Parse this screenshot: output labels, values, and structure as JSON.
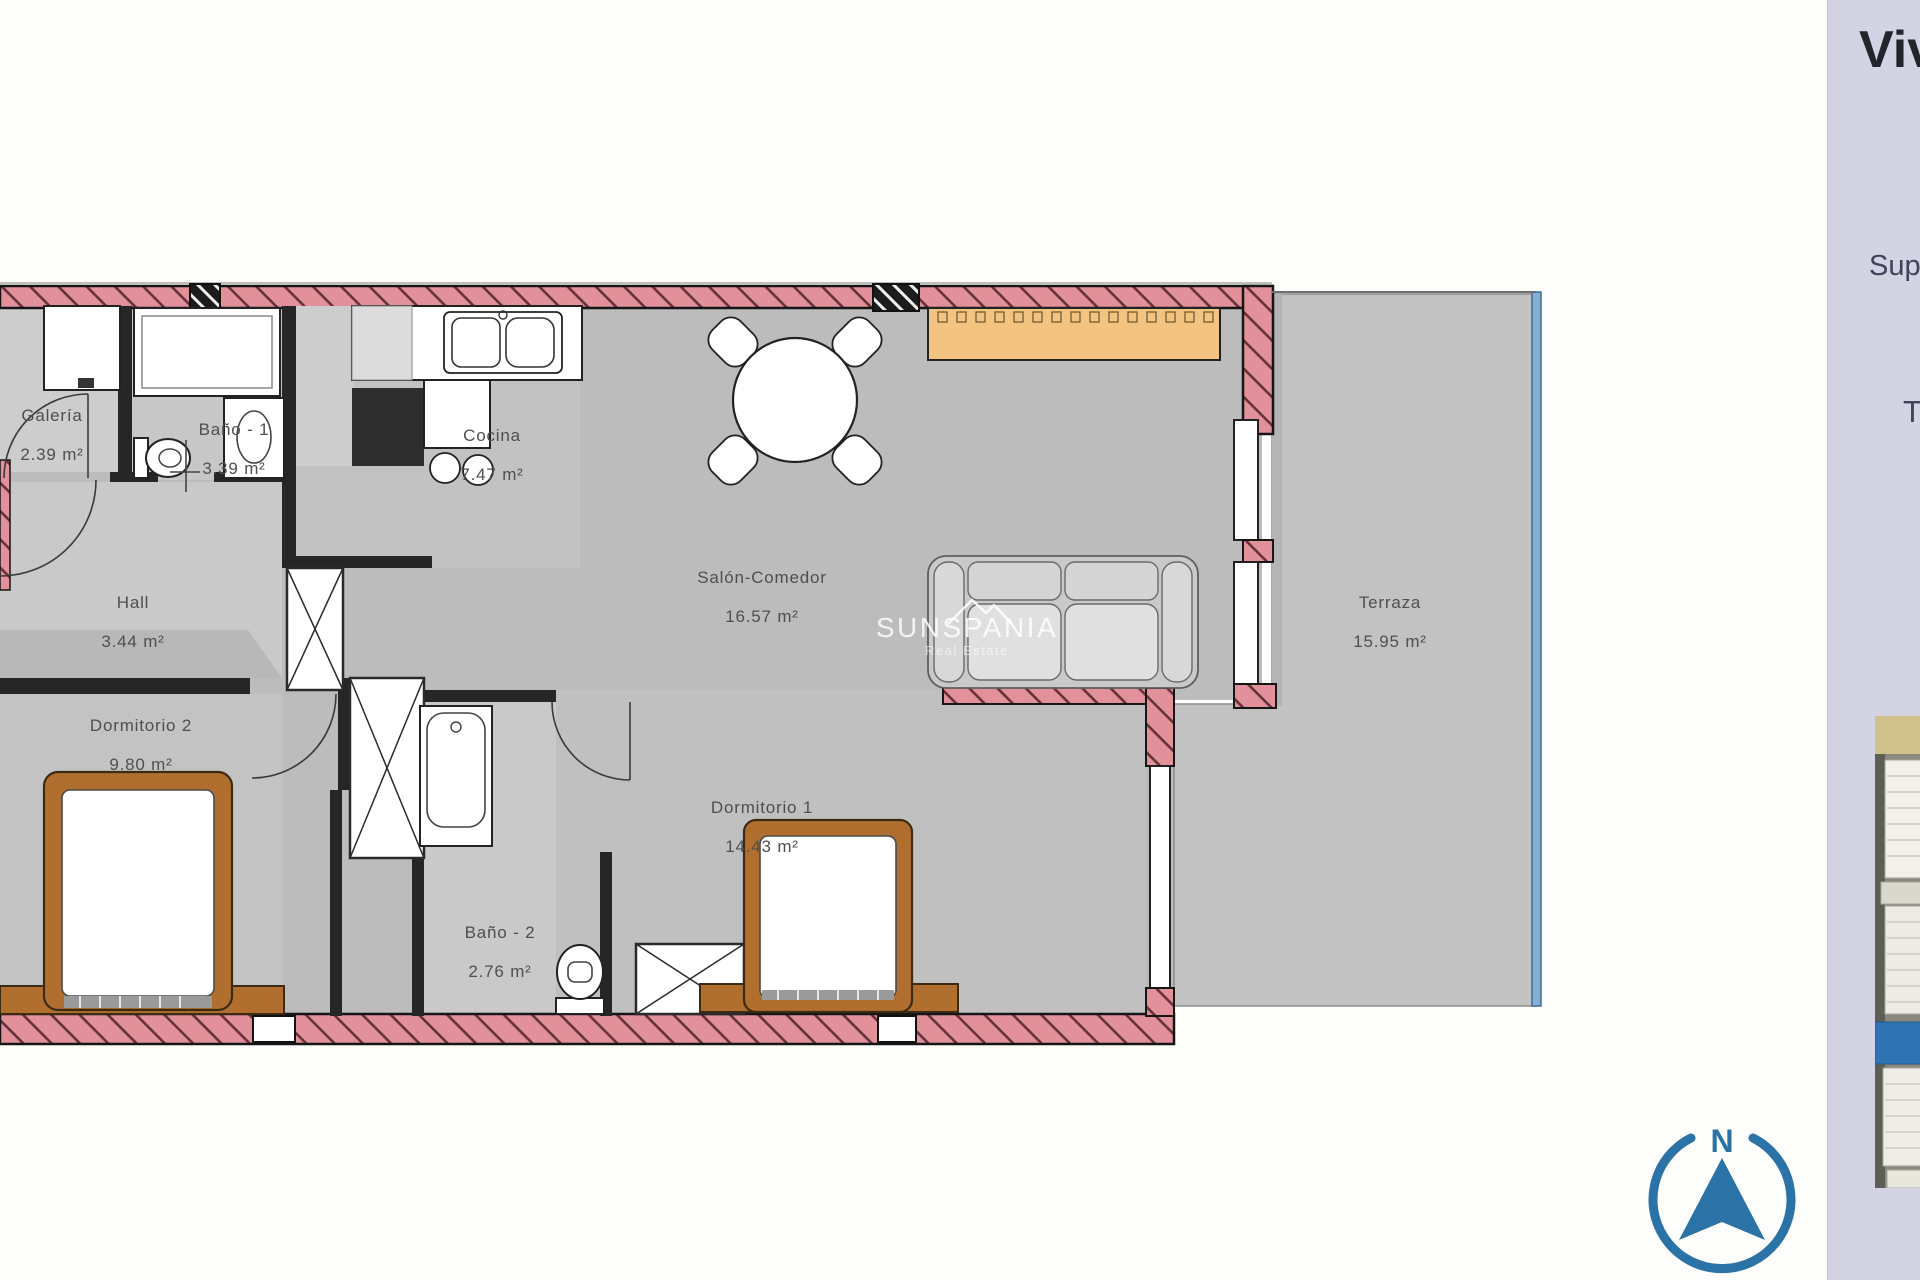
{
  "rooms": {
    "galeria": {
      "name": "Galería",
      "area": "2.39 m²"
    },
    "bano1": {
      "name": "Baño - 1",
      "area": "3.39 m²"
    },
    "cocina": {
      "name": "Cocina",
      "area": "7.47 m²"
    },
    "salon": {
      "name": "Salón-Comedor",
      "area": "16.57 m²"
    },
    "hall": {
      "name": "Hall",
      "area": "3.44 m²"
    },
    "dorm2": {
      "name": "Dormitorio 2",
      "area": "9.80 m²"
    },
    "dorm1": {
      "name": "Dormitorio 1",
      "area": "14.43 m²"
    },
    "bano2": {
      "name": "Baño - 2",
      "area": "2.76 m²"
    },
    "terraza": {
      "name": "Terraza",
      "area": "15.95 m²"
    }
  },
  "watermark": {
    "brand": "SUNSPANIA",
    "tagline": "Real Estate"
  },
  "panel": {
    "title_partial": "Viv",
    "subtitle_partial": "Sup",
    "line_partial": "T"
  },
  "compass": {
    "north_label": "N"
  },
  "colors": {
    "wall_pink": "#e2919b",
    "floor_gray": "#bcbcbc",
    "accent_blue": "#2b72a7",
    "panel_bg": "#d3d3e4",
    "furniture_wood": "#b06f2e",
    "sideboard_tan": "#f2c381",
    "terrace_glass_blue": "#86aed0"
  }
}
